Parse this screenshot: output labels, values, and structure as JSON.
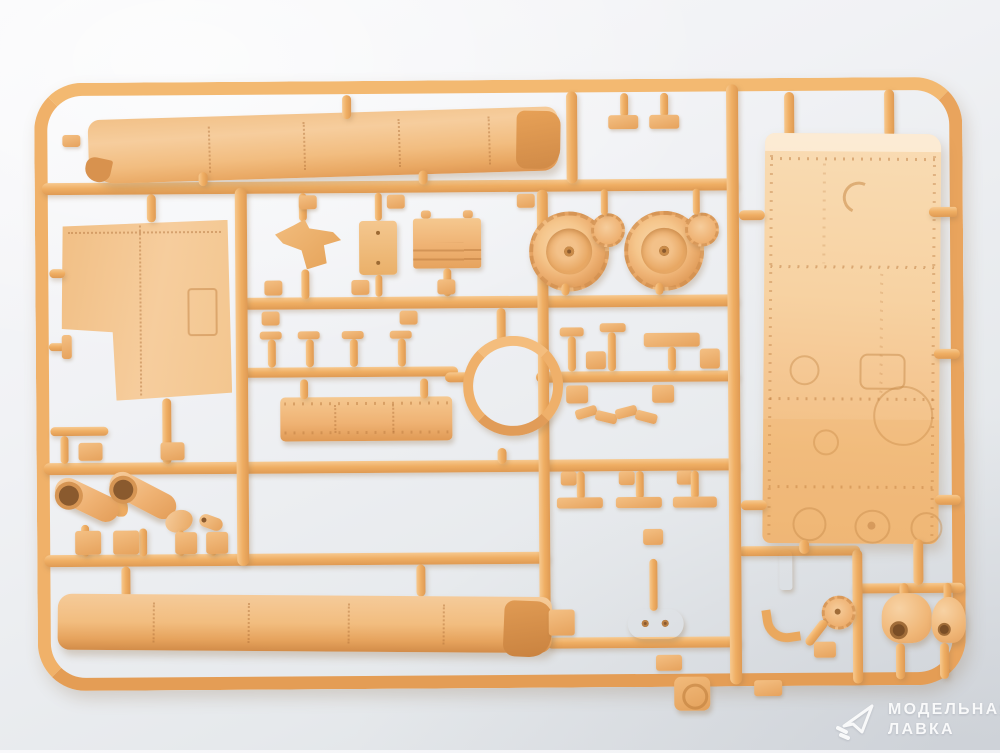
{
  "watermark": {
    "line1": "МОДЕЛЬНАЯ",
    "line2": "ЛАВКА",
    "icon": "paper-plane-icon",
    "text_color": "#ffffff"
  },
  "palette": {
    "background_top": "#f8f8fa",
    "background_bottom": "#d9dde2",
    "plastic_runner": "#efad61",
    "plastic_light": "#f7d0a0",
    "plastic_dark": "#d8924e",
    "plastic_panel": "#f6d2a6",
    "rivet_detail": "#b97e41"
  }
}
